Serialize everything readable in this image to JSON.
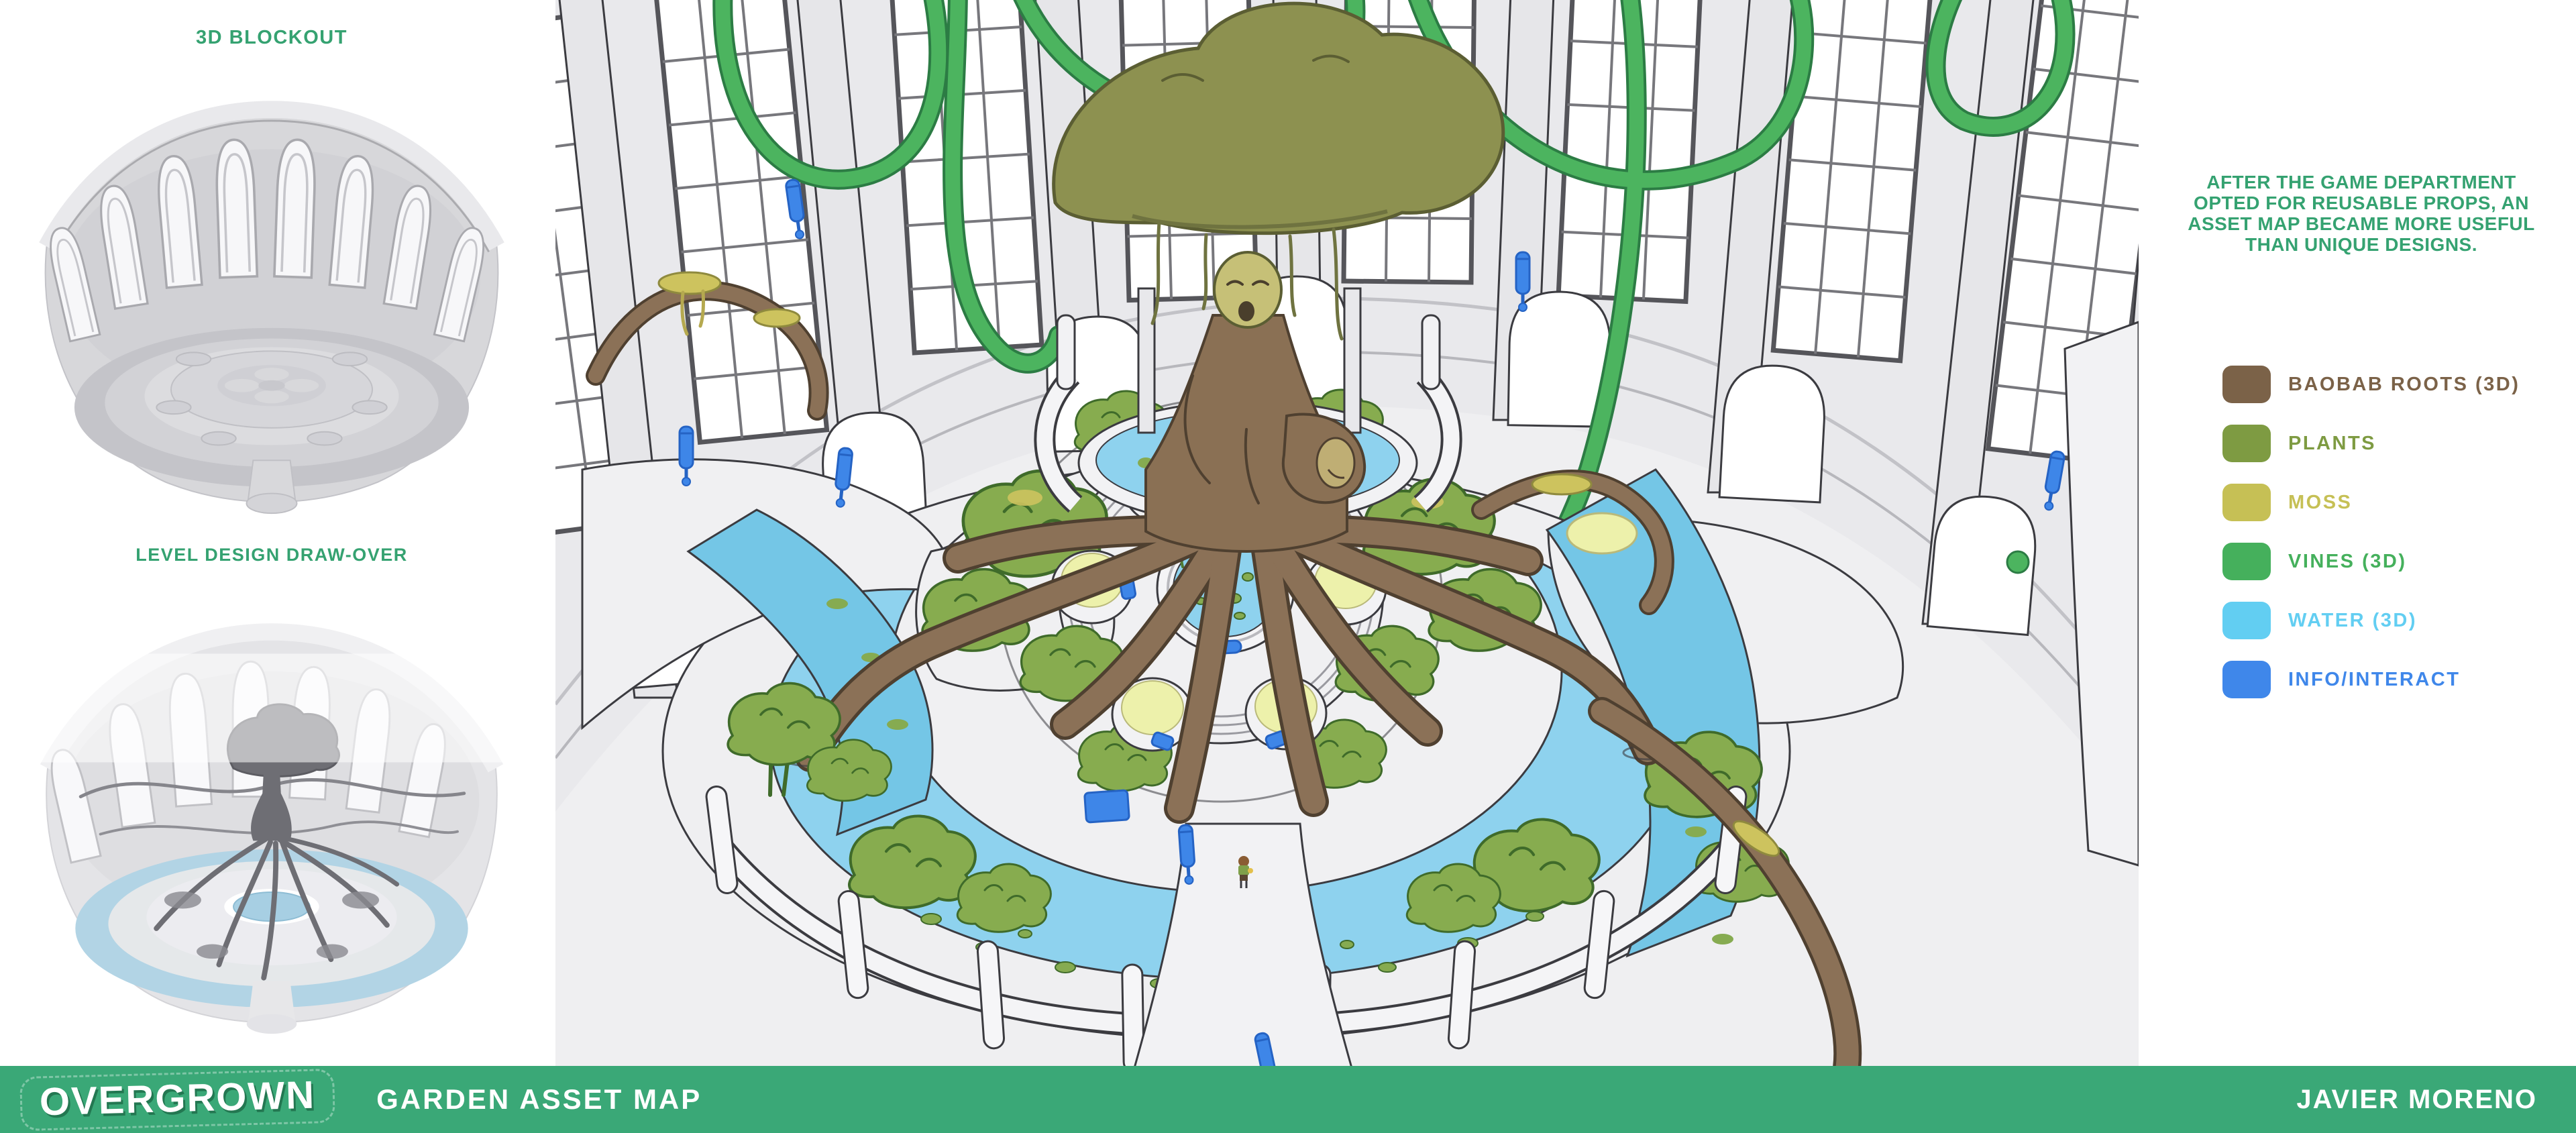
{
  "sidebar": {
    "blockout_label": "3D BLOCKOUT",
    "drawover_label": "LEVEL DESIGN DRAW-OVER",
    "label_color": "#35a271"
  },
  "note": {
    "line1": "AFTER THE GAME DEPARTMENT",
    "line2": "OPTED FOR REUSABLE PROPS, AN",
    "line3": "ASSET MAP BECAME MORE USEFUL",
    "line4": "THAN UNIQUE DESIGNS.",
    "color": "#35a271"
  },
  "legend": {
    "items": [
      {
        "label": "BAOBAB ROOTS (3D)",
        "color": "#7b6248"
      },
      {
        "label": "PLANTS",
        "color": "#7e9b42"
      },
      {
        "label": "MOSS",
        "color": "#c6c055"
      },
      {
        "label": "VINES (3D)",
        "color": "#45b05c"
      },
      {
        "label": "WATER (3D)",
        "color": "#62cef2"
      },
      {
        "label": "INFO/INTERACT",
        "color": "#3f87ea"
      }
    ]
  },
  "footer": {
    "logo_text": "OVERGROWN",
    "project_title": "GARDEN ASSET MAP",
    "author": "JAVIER MORENO",
    "bar_color": "#3aa877"
  },
  "scene": {
    "palette": {
      "wall_gray": "#e9e9ec",
      "floor_gray": "#efeff1",
      "water_blue": "#8ed2ee",
      "channel_blue": "#74c6e6",
      "plant_green": "#87ac4f",
      "vine_green": "#4cb45f",
      "moss_yellow": "#cdc35e",
      "planter_moss_top": "#edf1ab",
      "root_brown": "#8b7157",
      "canopy_olive": "#8d9150",
      "info_blue": "#3e86e8"
    }
  }
}
